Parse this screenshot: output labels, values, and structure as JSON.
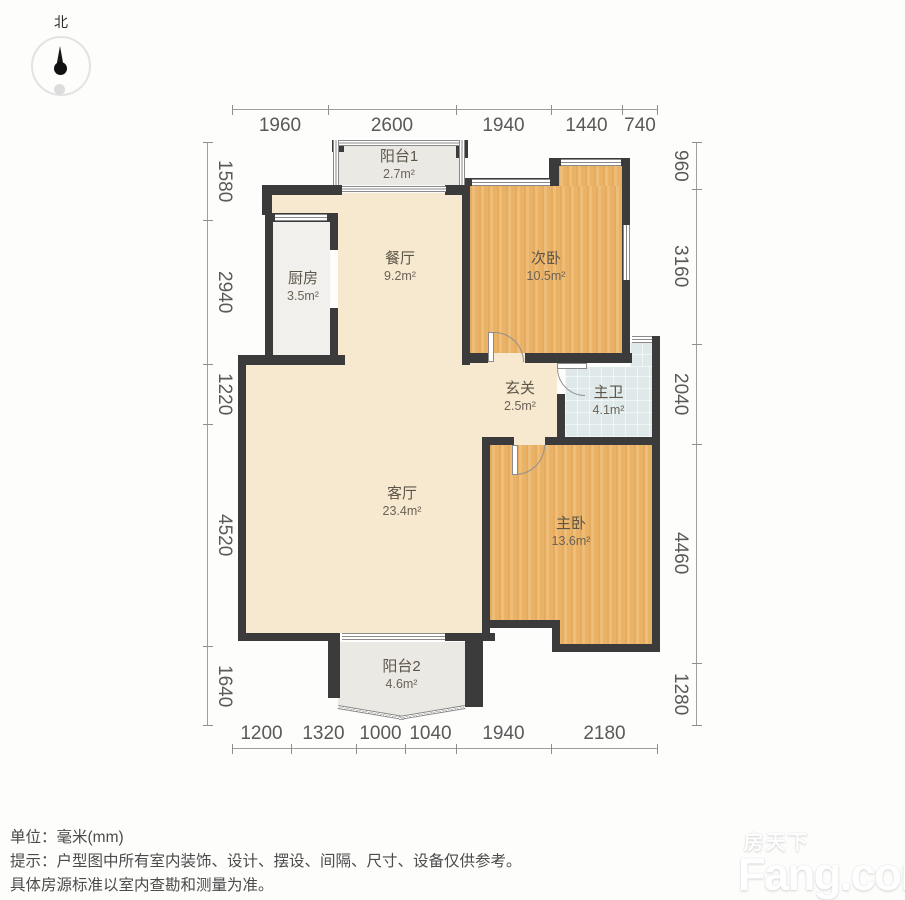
{
  "compass": {
    "label": "北"
  },
  "dimensions": {
    "unit": "mm",
    "top": [
      "1960",
      "2600",
      "1940",
      "1440",
      "740"
    ],
    "bottom": [
      "1200",
      "1320",
      "1000",
      "1040",
      "1940",
      "2180"
    ],
    "left": [
      "1580",
      "2940",
      "1220",
      "4520",
      "1640"
    ],
    "right": [
      "960",
      "3160",
      "2040",
      "4460",
      "1280"
    ]
  },
  "rooms": {
    "balcony1": {
      "name": "阳台1",
      "area": "2.7m²"
    },
    "kitchen": {
      "name": "厨房",
      "area": "3.5m²"
    },
    "dining": {
      "name": "餐厅",
      "area": "9.2m²"
    },
    "second_bedroom": {
      "name": "次卧",
      "area": "10.5m²"
    },
    "entry": {
      "name": "玄关",
      "area": "2.5m²"
    },
    "master_bath": {
      "name": "主卫",
      "area": "4.1m²"
    },
    "living": {
      "name": "客厅",
      "area": "23.4m²"
    },
    "master_bedroom": {
      "name": "主卧",
      "area": "13.6m²"
    },
    "balcony2": {
      "name": "阳台2",
      "area": "4.6m²"
    }
  },
  "footer": {
    "unit_line": "单位：毫米(mm)",
    "tip_line1": "提示：户型图中所有室内装饰、设计、摆设、间隔、尺寸、设备仅供参考。",
    "tip_line2": "具体房源标准以室内查勘和测量为准。"
  },
  "watermark": {
    "brand_cn": "房天下",
    "brand_en": "Fang.com"
  },
  "colors": {
    "wall": "#3b3b3b",
    "wood_floor": "#e9b46b",
    "cream_floor": "#f6e9d0",
    "gray_floor": "#ebe9e3",
    "bath_floor": "#dfe9ea"
  }
}
